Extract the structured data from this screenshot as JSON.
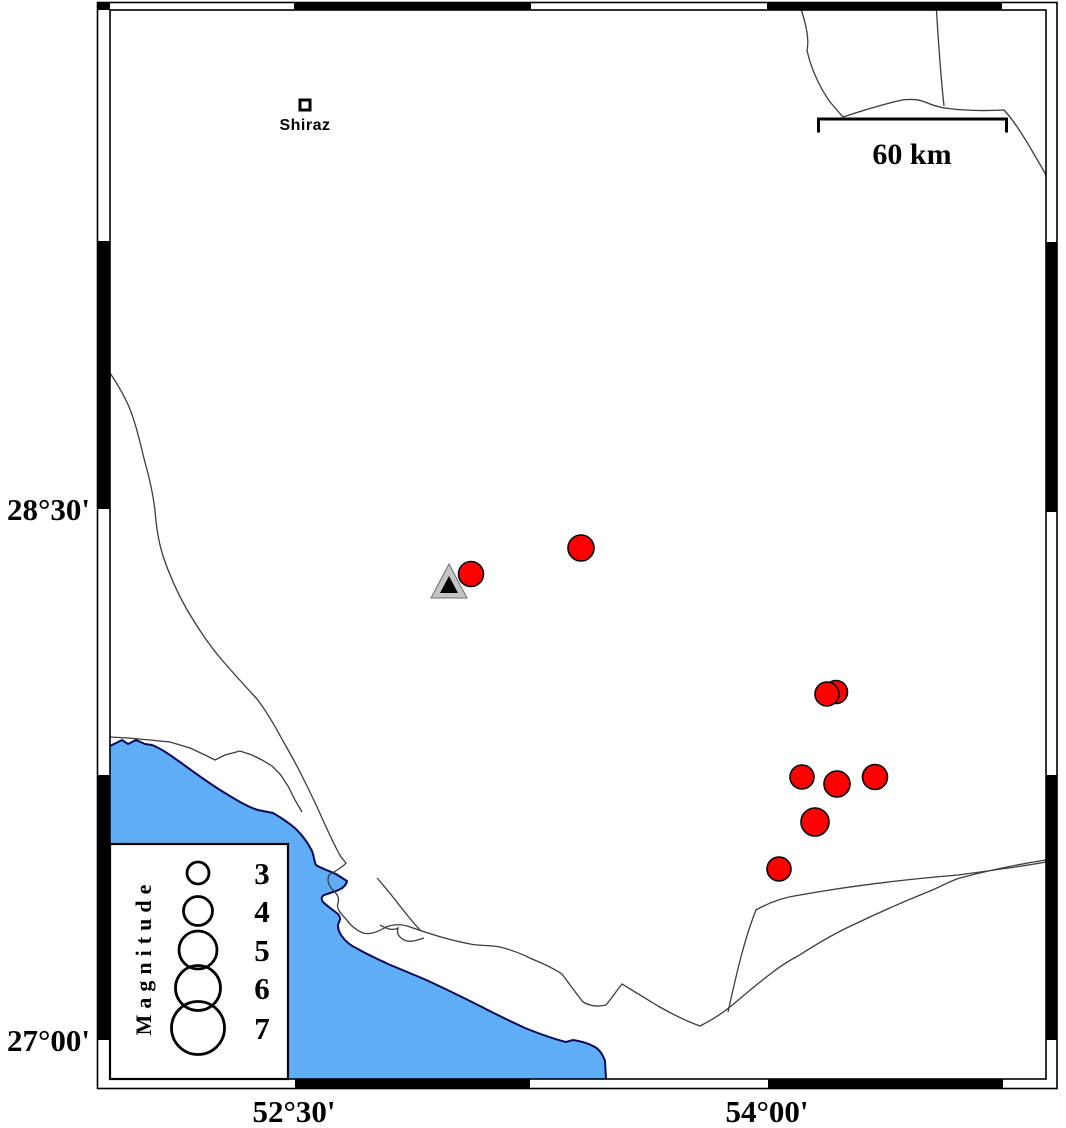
{
  "frame": {
    "lat_labels": [
      {
        "text": "28°30'",
        "y": 509
      },
      {
        "text": "27°00'",
        "y": 1040
      }
    ],
    "lon_labels": [
      {
        "text": "52°30'",
        "x": 294
      },
      {
        "text": "54°00'",
        "x": 767
      }
    ]
  },
  "city": {
    "name": "Shiraz"
  },
  "scale_bar": {
    "label": "60 km"
  },
  "legend": {
    "title": "Magnitude",
    "entries": [
      {
        "label": "3",
        "r": 11,
        "cy": 873
      },
      {
        "label": "4",
        "r": 14.5,
        "cy": 911
      },
      {
        "label": "5",
        "r": 19,
        "cy": 950
      },
      {
        "label": "6",
        "r": 22.5,
        "cy": 988
      },
      {
        "label": "7",
        "r": 26.5,
        "cy": 1028
      }
    ]
  },
  "events": [
    {
      "x": 471,
      "y": 574,
      "r": 12.5
    },
    {
      "x": 581,
      "y": 548,
      "r": 13
    },
    {
      "x": 836,
      "y": 692,
      "r": 11.5
    },
    {
      "x": 827,
      "y": 694,
      "r": 12
    },
    {
      "x": 802,
      "y": 777,
      "r": 12
    },
    {
      "x": 837,
      "y": 784,
      "r": 13
    },
    {
      "x": 875,
      "y": 777,
      "r": 12.5
    },
    {
      "x": 815,
      "y": 822,
      "r": 14
    },
    {
      "x": 779,
      "y": 869,
      "r": 12
    }
  ],
  "station": {
    "x": 449,
    "y": 584
  },
  "colors": {
    "water": "#5FAEF5",
    "coast_edge": "#0a0a5a",
    "event_fill": "#FF0000",
    "station_fill": "#c4c4c4",
    "frame_black": "#000000"
  }
}
